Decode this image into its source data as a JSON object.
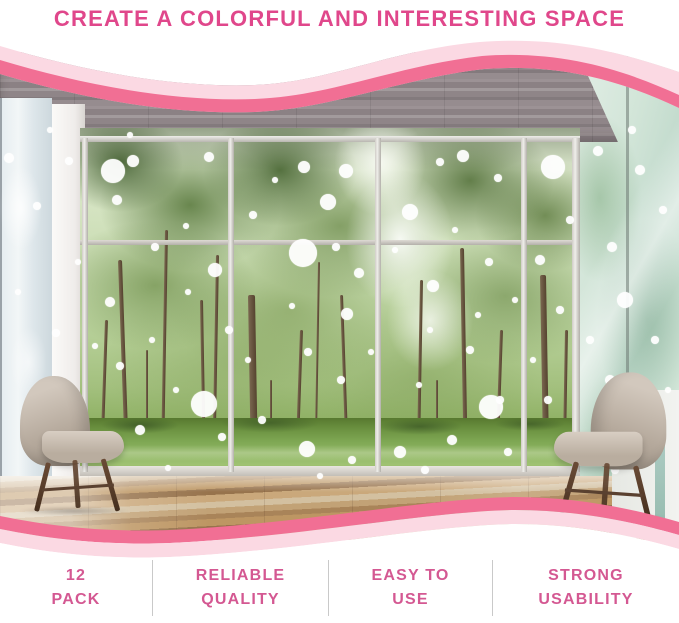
{
  "title": {
    "text": "CREATE A COLORFUL AND INTERESTING SPACE"
  },
  "features": {
    "items": [
      {
        "line1": "12",
        "line2": "PACK"
      },
      {
        "line1": "RELIABLE",
        "line2": "QUALITY"
      },
      {
        "line1": "EASY TO",
        "line2": "USE"
      },
      {
        "line1": "STRONG",
        "line2": "USABILITY"
      }
    ]
  },
  "colors": {
    "title_pink": "#e0478b",
    "feature_pink": "#d45892",
    "wave_deep_pink": "#f16f94",
    "wave_light_pink": "#fbd9e3",
    "divider_gray": "#c9c9c9"
  },
  "photo": {
    "description": "living room with wood ceiling, glass wall onto green trees and lawn, two beige tub armchairs, white polka-dot decals stuck on the windows",
    "dots": [
      [
        9,
        158,
        5
      ],
      [
        69,
        161,
        4
      ],
      [
        37,
        206,
        4
      ],
      [
        18,
        292,
        3
      ],
      [
        56,
        333,
        4
      ],
      [
        30,
        421,
        4
      ],
      [
        78,
        262,
        3
      ],
      [
        50,
        130,
        3
      ],
      [
        113,
        171,
        12
      ],
      [
        133,
        161,
        6
      ],
      [
        209,
        157,
        5
      ],
      [
        117,
        200,
        5
      ],
      [
        186,
        226,
        3
      ],
      [
        155,
        247,
        4
      ],
      [
        215,
        270,
        7
      ],
      [
        110,
        302,
        5
      ],
      [
        188,
        292,
        3
      ],
      [
        152,
        340,
        3
      ],
      [
        120,
        366,
        4
      ],
      [
        176,
        390,
        3
      ],
      [
        140,
        430,
        5
      ],
      [
        95,
        346,
        3
      ],
      [
        222,
        437,
        4
      ],
      [
        168,
        468,
        3
      ],
      [
        204,
        404,
        13
      ],
      [
        229,
        330,
        4
      ],
      [
        130,
        135,
        3
      ],
      [
        304,
        167,
        6
      ],
      [
        346,
        171,
        7
      ],
      [
        328,
        202,
        8
      ],
      [
        303,
        253,
        14
      ],
      [
        359,
        273,
        5
      ],
      [
        347,
        314,
        6
      ],
      [
        292,
        306,
        3
      ],
      [
        336,
        247,
        4
      ],
      [
        253,
        215,
        4
      ],
      [
        275,
        180,
        3
      ],
      [
        308,
        352,
        4
      ],
      [
        248,
        360,
        3
      ],
      [
        341,
        380,
        4
      ],
      [
        262,
        420,
        4
      ],
      [
        307,
        449,
        8
      ],
      [
        352,
        460,
        4
      ],
      [
        320,
        476,
        3
      ],
      [
        371,
        352,
        3
      ],
      [
        410,
        212,
        8
      ],
      [
        433,
        286,
        6
      ],
      [
        463,
        156,
        6
      ],
      [
        498,
        178,
        4
      ],
      [
        455,
        230,
        3
      ],
      [
        489,
        262,
        4
      ],
      [
        430,
        330,
        3
      ],
      [
        470,
        350,
        4
      ],
      [
        419,
        385,
        3
      ],
      [
        500,
        400,
        4
      ],
      [
        452,
        440,
        5
      ],
      [
        515,
        300,
        3
      ],
      [
        440,
        162,
        4
      ],
      [
        395,
        250,
        3
      ],
      [
        425,
        470,
        4
      ],
      [
        491,
        407,
        12
      ],
      [
        508,
        452,
        4
      ],
      [
        478,
        315,
        3
      ],
      [
        400,
        452,
        6
      ],
      [
        553,
        167,
        12
      ],
      [
        598,
        151,
        5
      ],
      [
        570,
        220,
        4
      ],
      [
        540,
        260,
        5
      ],
      [
        560,
        310,
        4
      ],
      [
        533,
        360,
        3
      ],
      [
        548,
        400,
        4
      ],
      [
        571,
        441,
        5
      ],
      [
        640,
        170,
        5
      ],
      [
        612,
        247,
        5
      ],
      [
        663,
        210,
        4
      ],
      [
        625,
        300,
        8
      ],
      [
        655,
        340,
        4
      ],
      [
        610,
        380,
        5
      ],
      [
        645,
        430,
        8
      ],
      [
        668,
        390,
        3
      ],
      [
        615,
        470,
        4
      ],
      [
        590,
        340,
        4
      ],
      [
        600,
        420,
        3
      ],
      [
        632,
        130,
        4
      ]
    ],
    "trunks": [
      [
        118,
        260,
        210,
        4,
        -2
      ],
      [
        165,
        230,
        240,
        3,
        1
      ],
      [
        200,
        300,
        170,
        3,
        -1
      ],
      [
        105,
        320,
        150,
        3,
        2
      ],
      [
        146,
        350,
        120,
        2,
        0
      ],
      [
        216,
        255,
        215,
        3,
        1
      ],
      [
        248,
        295,
        178,
        7,
        -1
      ],
      [
        300,
        330,
        142,
        3,
        2
      ],
      [
        340,
        295,
        177,
        3,
        -2
      ],
      [
        270,
        380,
        92,
        2,
        0
      ],
      [
        318,
        262,
        210,
        2,
        1
      ],
      [
        420,
        280,
        192,
        3,
        1
      ],
      [
        460,
        248,
        224,
        4,
        -1
      ],
      [
        500,
        330,
        142,
        3,
        2
      ],
      [
        436,
        380,
        92,
        2,
        0
      ],
      [
        540,
        275,
        197,
        6,
        -1
      ],
      [
        565,
        330,
        142,
        3,
        1
      ]
    ]
  }
}
